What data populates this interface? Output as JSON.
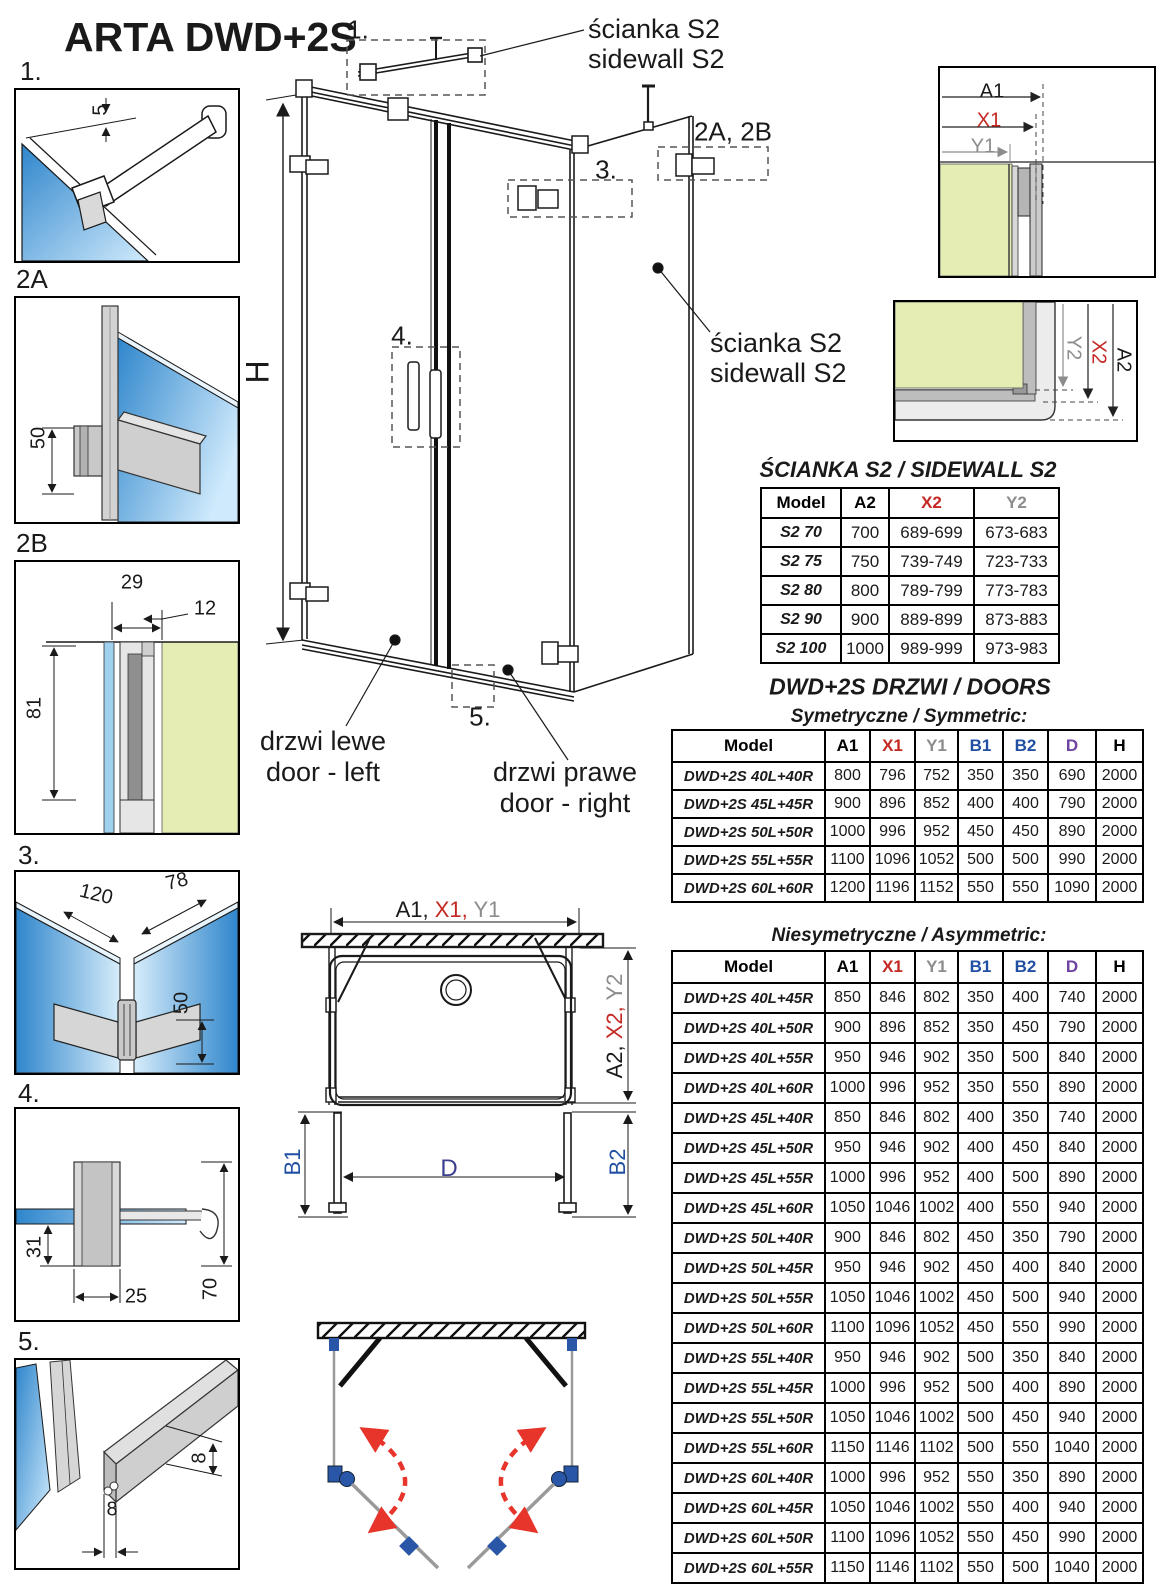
{
  "title": "ARTA DWD+2S",
  "colors": {
    "red": "#c52722",
    "gray_label": "#8c8c8c",
    "blue_label": "#2150a3",
    "purple_label": "#6f43a1",
    "glass_green": "#e5edb5",
    "glass_blue_dark": "#2f86cc",
    "glass_blue_light": "#cfeafc",
    "profile_gray": "#c9c9c9",
    "swing_red": "#e8352b",
    "hinge_blue": "#2a56a8"
  },
  "details_panel": {
    "d1": {
      "label": "1.",
      "dim5": "5"
    },
    "d2a": {
      "label": "2A",
      "dim50": "50"
    },
    "d2b": {
      "label": "2B",
      "dim29": "29",
      "dim12": "12",
      "dim81": "81"
    },
    "d3": {
      "label": "3.",
      "dim120": "120",
      "dim78": "78",
      "dim50": "50"
    },
    "d4": {
      "label": "4.",
      "dim31": "31",
      "dim25": "25",
      "dim70": "70"
    },
    "d5": {
      "label": "5.",
      "dim8_height": "8",
      "dim8_width": "8"
    }
  },
  "main_drawing": {
    "callouts": {
      "c1": "1.",
      "c2ab": "2A, 2B",
      "c3": "3.",
      "c4": "4.",
      "c5": "5."
    },
    "height_label": "H",
    "sidewall_top": {
      "line1": "ścianka S2",
      "line2": "sidewall S2"
    },
    "sidewall_right": {
      "line1": "ścianka S2",
      "line2": "sidewall S2"
    },
    "door_left": {
      "line1": "drzwi lewe",
      "line2": "door - left"
    },
    "door_right": {
      "line1": "drzwi prawe",
      "line2": "door - right"
    }
  },
  "corner_detail_top": {
    "a1": "A1",
    "x1": "X1",
    "y1": "Y1"
  },
  "corner_detail_bottom": {
    "y2": "Y2",
    "x2": "X2",
    "a2": "A2"
  },
  "plan_view": {
    "top_dim": {
      "a1": "A1,",
      "x1": "X1,",
      "y1": "Y1"
    },
    "right_dim": {
      "a2": "A2,",
      "x2": "X2,",
      "y2": "Y2"
    },
    "b1": "B1",
    "b2": "B2",
    "d": "D"
  },
  "sidewall_table": {
    "title": "ŚCIANKA S2 / SIDEWALL S2",
    "headers": [
      "Model",
      "A2",
      "X2",
      "Y2"
    ],
    "header_colors": [
      "#000000",
      "#000000",
      "#c52722",
      "#8c8c8c"
    ],
    "rows": [
      [
        "S2 70",
        "700",
        "689-699",
        "673-683"
      ],
      [
        "S2 75",
        "750",
        "739-749",
        "723-733"
      ],
      [
        "S2 80",
        "800",
        "789-799",
        "773-783"
      ],
      [
        "S2 90",
        "900",
        "889-899",
        "873-883"
      ],
      [
        "S2 100",
        "1000",
        "989-999",
        "973-983"
      ]
    ]
  },
  "doors_tables": {
    "title": "DWD+2S DRZWI / DOORS",
    "symmetric_title": "Symetryczne / Symmetric:",
    "asymmetric_title": "Niesymetryczne / Asymmetric:",
    "headers": [
      "Model",
      "A1",
      "X1",
      "Y1",
      "B1",
      "B2",
      "D",
      "H"
    ],
    "header_colors": [
      "#000000",
      "#000000",
      "#c52722",
      "#8c8c8c",
      "#2150a3",
      "#2150a3",
      "#6f43a1",
      "#000000"
    ],
    "symmetric_rows": [
      [
        "DWD+2S 40L+40R",
        "800",
        "796",
        "752",
        "350",
        "350",
        "690",
        "2000"
      ],
      [
        "DWD+2S 45L+45R",
        "900",
        "896",
        "852",
        "400",
        "400",
        "790",
        "2000"
      ],
      [
        "DWD+2S 50L+50R",
        "1000",
        "996",
        "952",
        "450",
        "450",
        "890",
        "2000"
      ],
      [
        "DWD+2S 55L+55R",
        "1100",
        "1096",
        "1052",
        "500",
        "500",
        "990",
        "2000"
      ],
      [
        "DWD+2S 60L+60R",
        "1200",
        "1196",
        "1152",
        "550",
        "550",
        "1090",
        "2000"
      ]
    ],
    "asymmetric_rows": [
      [
        "DWD+2S 40L+45R",
        "850",
        "846",
        "802",
        "350",
        "400",
        "740",
        "2000"
      ],
      [
        "DWD+2S 40L+50R",
        "900",
        "896",
        "852",
        "350",
        "450",
        "790",
        "2000"
      ],
      [
        "DWD+2S 40L+55R",
        "950",
        "946",
        "902",
        "350",
        "500",
        "840",
        "2000"
      ],
      [
        "DWD+2S 40L+60R",
        "1000",
        "996",
        "952",
        "350",
        "550",
        "890",
        "2000"
      ],
      [
        "DWD+2S 45L+40R",
        "850",
        "846",
        "802",
        "400",
        "350",
        "740",
        "2000"
      ],
      [
        "DWD+2S 45L+50R",
        "950",
        "946",
        "902",
        "400",
        "450",
        "840",
        "2000"
      ],
      [
        "DWD+2S 45L+55R",
        "1000",
        "996",
        "952",
        "400",
        "500",
        "890",
        "2000"
      ],
      [
        "DWD+2S 45L+60R",
        "1050",
        "1046",
        "1002",
        "400",
        "550",
        "940",
        "2000"
      ],
      [
        "DWD+2S 50L+40R",
        "900",
        "846",
        "802",
        "450",
        "350",
        "790",
        "2000"
      ],
      [
        "DWD+2S 50L+45R",
        "950",
        "946",
        "902",
        "450",
        "400",
        "840",
        "2000"
      ],
      [
        "DWD+2S 50L+55R",
        "1050",
        "1046",
        "1002",
        "450",
        "500",
        "940",
        "2000"
      ],
      [
        "DWD+2S 50L+60R",
        "1100",
        "1096",
        "1052",
        "450",
        "550",
        "990",
        "2000"
      ],
      [
        "DWD+2S 55L+40R",
        "950",
        "946",
        "902",
        "500",
        "350",
        "840",
        "2000"
      ],
      [
        "DWD+2S 55L+45R",
        "1000",
        "996",
        "952",
        "500",
        "400",
        "890",
        "2000"
      ],
      [
        "DWD+2S 55L+50R",
        "1050",
        "1046",
        "1002",
        "500",
        "450",
        "940",
        "2000"
      ],
      [
        "DWD+2S 55L+60R",
        "1150",
        "1146",
        "1102",
        "500",
        "550",
        "1040",
        "2000"
      ],
      [
        "DWD+2S 60L+40R",
        "1000",
        "996",
        "952",
        "550",
        "350",
        "890",
        "2000"
      ],
      [
        "DWD+2S 60L+45R",
        "1050",
        "1046",
        "1002",
        "550",
        "400",
        "940",
        "2000"
      ],
      [
        "DWD+2S 60L+50R",
        "1100",
        "1096",
        "1052",
        "550",
        "450",
        "990",
        "2000"
      ],
      [
        "DWD+2S 60L+55R",
        "1150",
        "1146",
        "1102",
        "550",
        "500",
        "1040",
        "2000"
      ]
    ]
  }
}
